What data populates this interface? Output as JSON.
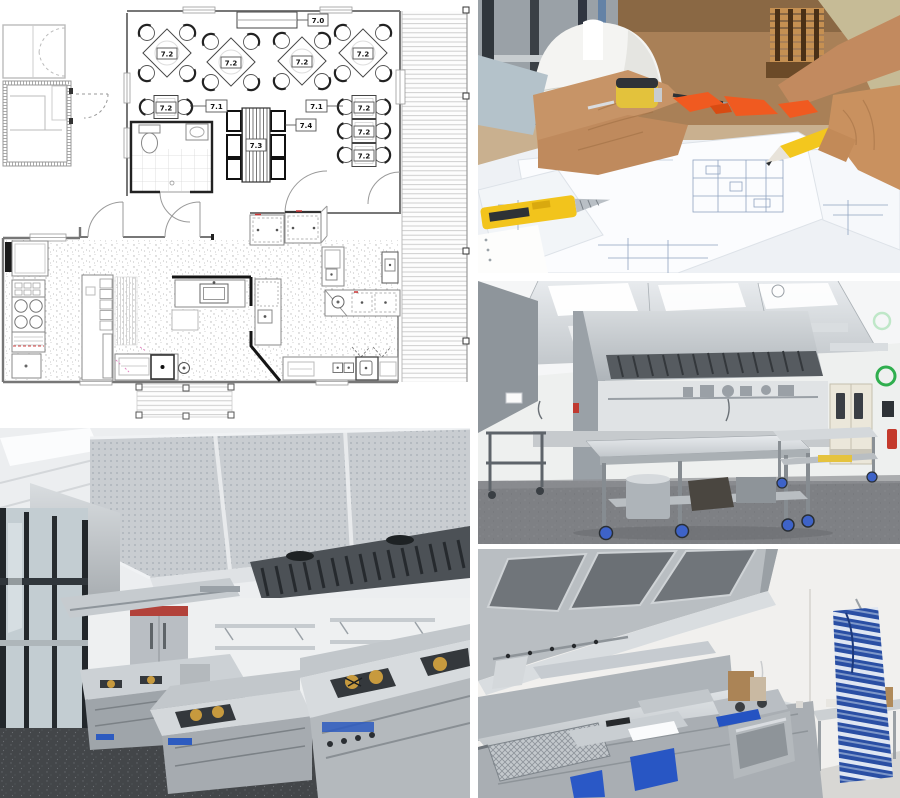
{
  "collage": {
    "background": "#ffffff",
    "floor_plan": {
      "name": "commercial-restaurant-floor-plan",
      "tags": {
        "t70": "7.0",
        "t71": "7.1",
        "t72": "7.2",
        "t73": "7.3",
        "t74": "7.4"
      },
      "line_color": "#4a4a4a",
      "accent_red": "#cc3a33",
      "paper_color": "#ffffff"
    },
    "photos": {
      "blueprint_review": {
        "name": "architects-reviewing-blueprints-photo",
        "palette": {
          "wood": "#a9805a",
          "hard_hat": "#f3f3f1",
          "skin": "#c79467",
          "paper": "#f4f6f8",
          "plan_lines": "#8fa3c0",
          "tool_yellow": "#f2c41c",
          "scrap_orange": "#f05a20"
        }
      },
      "kitchen_island": {
        "name": "stainless-kitchen-island-photo",
        "palette": {
          "wall": "#eef0ef",
          "stainless": "#c2c7cb",
          "floor": "#7d7f83",
          "door_cream": "#ebe7da",
          "sticker_green": "#2fae4e",
          "extinguisher_red": "#c43a2c",
          "caster_blue": "#3e63c8"
        }
      },
      "kitchen_gas_line": {
        "name": "training-kitchen-gas-line-photo",
        "palette": {
          "hood": "#c9cdd1",
          "filters": "#4c5156",
          "bench": "#cfd4d7",
          "floor": "#434649",
          "glass_frame": "#22272b",
          "burner_brass": "#c79a3e",
          "label_blue": "#2d5bc0"
        }
      },
      "kitchen_fry_line": {
        "name": "kitchen-fry-line-photo",
        "palette": {
          "wall": "#f1f0ee",
          "hood": "#b9bec2",
          "filter_mesh": "#70757a",
          "counter": "#d6dadd",
          "drawer_blue": "#2856c4",
          "apron_blue": "#2a4fa4",
          "floor": "#d8d7d4"
        }
      }
    }
  }
}
